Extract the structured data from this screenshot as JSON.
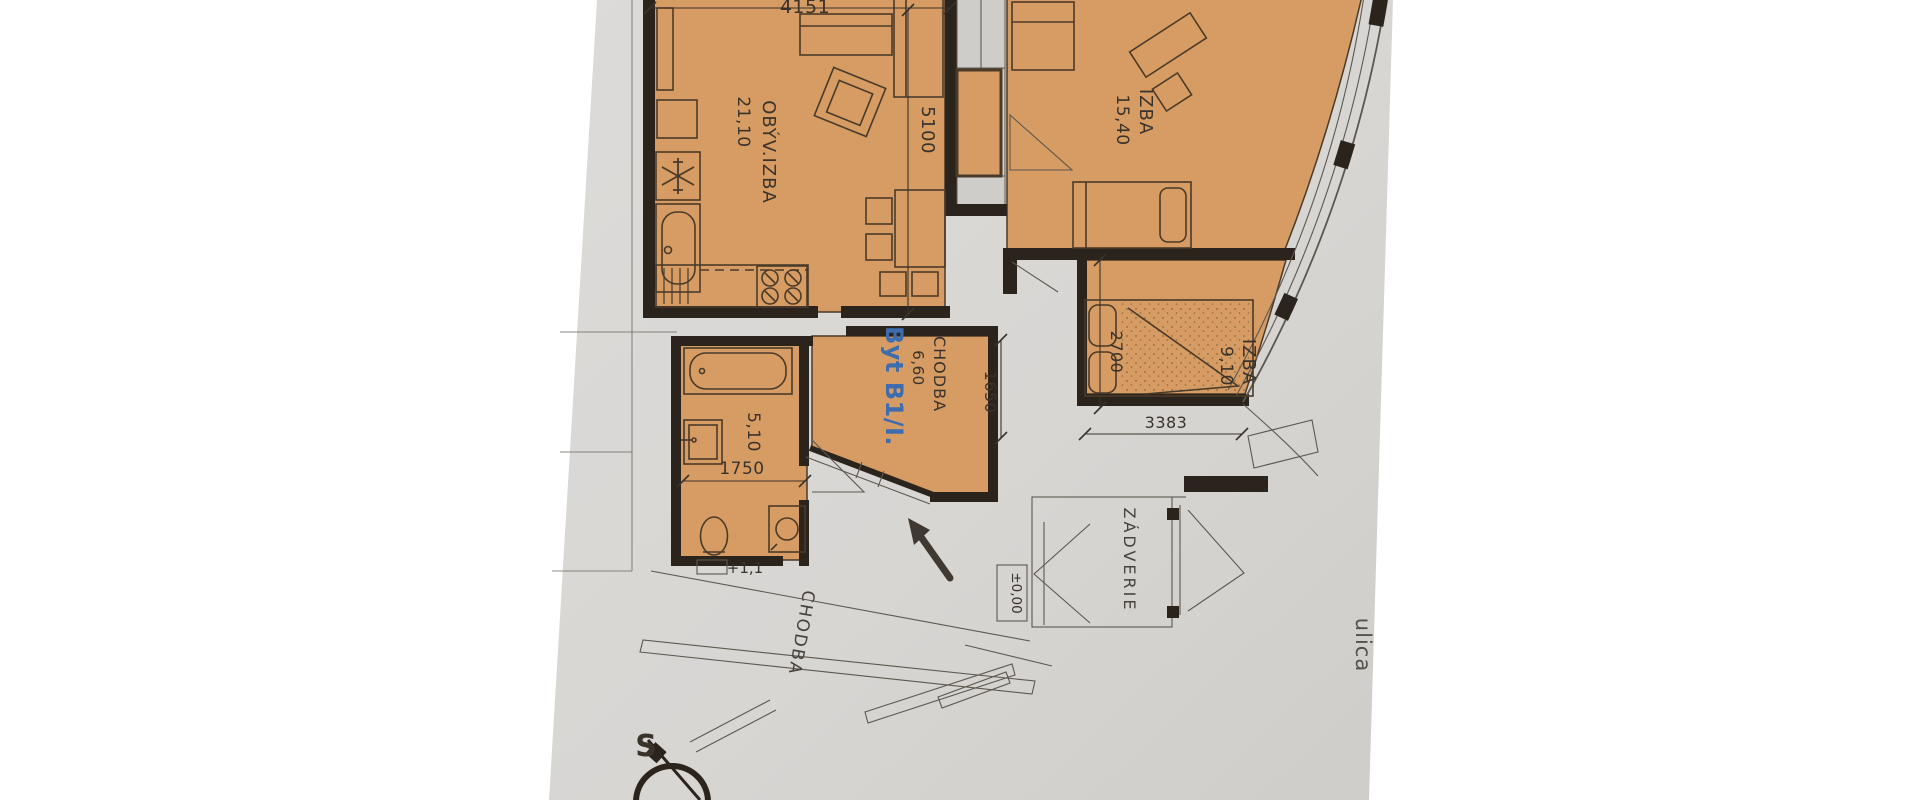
{
  "plan": {
    "apartment_label": "Byt B1/I.",
    "rooms": {
      "living": {
        "name": "OBÝV.IZBA",
        "area": "21,10"
      },
      "bedroom1": {
        "name": "IZBA",
        "area": "15,40"
      },
      "bedroom2": {
        "name": "IZBA",
        "area": "9,10"
      },
      "hall": {
        "name": "CHODBA",
        "area": "6,60"
      },
      "bathroom": {
        "area": "5,10"
      },
      "vestibule": {
        "name": "ZÁDVERIE"
      },
      "corridor": {
        "name": "CHODBA"
      }
    },
    "dimensions": {
      "living_top": "4151",
      "living_height": "5100",
      "hall_height": "1650",
      "bathroom_width": "1750",
      "bedroom2_height": "2700",
      "bedroom2_width": "3383"
    },
    "levels": {
      "entrance": "±0,00",
      "bathroom": "+1,1"
    },
    "street_label": "ulica",
    "compass_north_label": "S",
    "colors": {
      "floor_fill": "#d69c64",
      "walls": "#2b241c",
      "apartment_accent_blue": "#3f6cae",
      "paper": "#d8d6d3"
    }
  }
}
